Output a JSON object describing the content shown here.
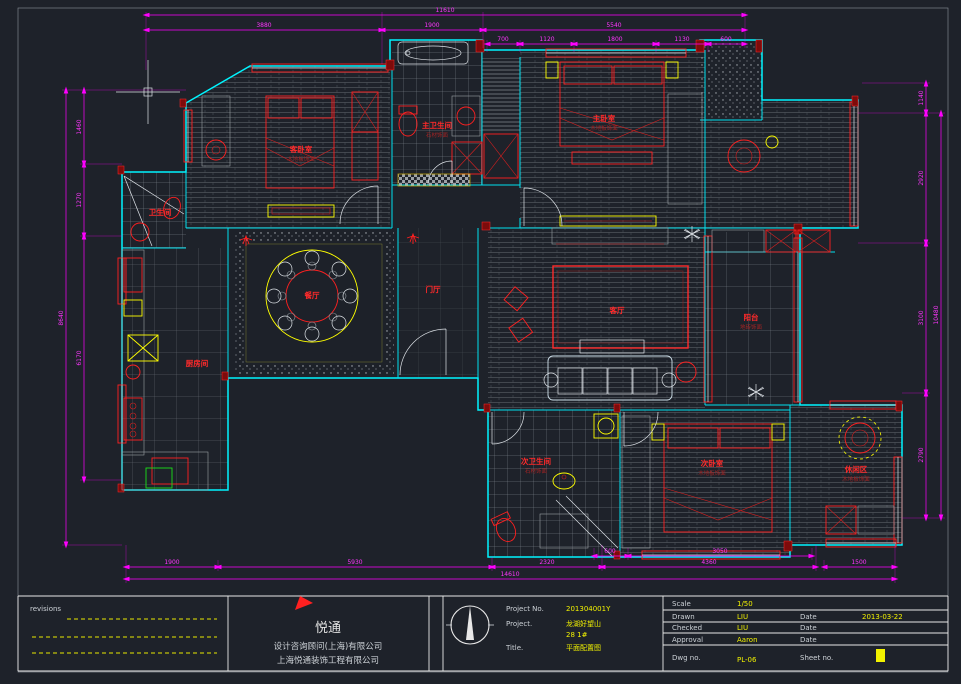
{
  "drawing": {
    "rooms": [
      {
        "id": "guest-bedroom",
        "name": "客卧室",
        "finish": "木地板饰面"
      },
      {
        "id": "master-bedroom",
        "name": "主卧室",
        "finish": "木地板饰面"
      },
      {
        "id": "master-bath",
        "name": "主卫生间",
        "finish": "石材饰面"
      },
      {
        "id": "bath",
        "name": "卫生间",
        "finish": ""
      },
      {
        "id": "kitchen",
        "name": "厨房间",
        "finish": ""
      },
      {
        "id": "dining",
        "name": "餐厅",
        "finish": ""
      },
      {
        "id": "foyer",
        "name": "门厅",
        "finish": ""
      },
      {
        "id": "living",
        "name": "客厅",
        "finish": ""
      },
      {
        "id": "balcony",
        "name": "阳台",
        "finish": "地砖饰面"
      },
      {
        "id": "bath2",
        "name": "次卫生间",
        "finish": "石材饰面"
      },
      {
        "id": "bedroom2",
        "name": "次卧室",
        "finish": "木地板饰面"
      },
      {
        "id": "leisure",
        "name": "休闲区",
        "finish": "木地板饰面"
      }
    ],
    "dims": {
      "top": [
        "11610",
        "3880",
        "1900",
        "5540",
        "700",
        "1120",
        "1800",
        "1130",
        "600"
      ],
      "bottom": [
        "600",
        "3050",
        "1900",
        "5930",
        "2320",
        "4360",
        "1500",
        "14610"
      ],
      "left": [
        "1460",
        "1270",
        "6170",
        "8640"
      ],
      "right": [
        "1140",
        "2920",
        "3100",
        "2790",
        "10480"
      ]
    }
  },
  "title_block": {
    "revisions_label": "revisions",
    "company": {
      "name": "悦通",
      "line1": "设计咨询顾问(上海)有限公司",
      "line2": "上海悦通装饰工程有限公司"
    },
    "project": {
      "no_label": "Project No.",
      "no_value": "201304001Y",
      "project_label": "Project.",
      "project_value_line1": "龙湖好望山",
      "project_value_line2": "28 1#",
      "title_label": "Title.",
      "title_value": "平面配置图"
    },
    "info": {
      "scale_label": "Scale",
      "scale_value": "1/50",
      "drawn_label": "Drawn",
      "drawn_value": "LIU",
      "date_label1": "Date",
      "drawn_date": "2013-03-22",
      "checked_label": "Checked",
      "checked_value": "LIU",
      "date_label2": "Date",
      "approval_label": "Approval",
      "approval_value": "Aaron",
      "date_label3": "Date",
      "dwg_label": "Dwg no.",
      "dwg_value": "PL-06",
      "sheet_label": "Sheet no."
    }
  },
  "colors": {
    "background": "#1e222a",
    "walls": "#00f5ff",
    "dimensions": "#ff00ff",
    "furniture": "#ff2020",
    "accent": "#ffff00"
  }
}
